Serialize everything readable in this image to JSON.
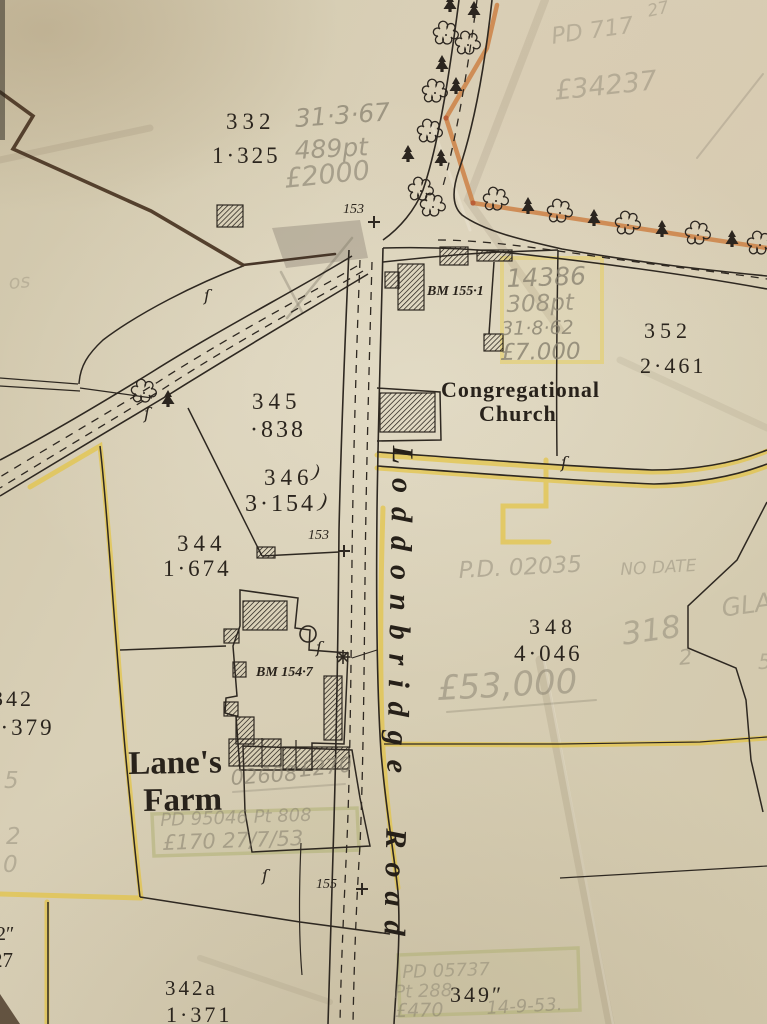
{
  "map_meta": {
    "description": "Scanned sheet of an Ordnance Survey style field parcel map with pencil valuation annotations",
    "road_name": "Loddonbridge Road"
  },
  "labels": [
    {
      "id": "parcel-332",
      "text": "332",
      "kind": "print",
      "x": 226,
      "y": 110,
      "size": 23,
      "ls": 5
    },
    {
      "id": "parcel-332-area",
      "text": "1·325",
      "kind": "print",
      "x": 212,
      "y": 144,
      "size": 23,
      "ls": 3
    },
    {
      "id": "parcel-345",
      "text": "345",
      "kind": "print",
      "x": 252,
      "y": 390,
      "size": 23,
      "ls": 5
    },
    {
      "id": "parcel-345-area",
      "text": "·838",
      "kind": "print",
      "x": 250,
      "y": 418,
      "size": 24,
      "ls": 3
    },
    {
      "id": "parcel-346",
      "text": "346",
      "kind": "print",
      "x": 264,
      "y": 466,
      "size": 23,
      "ls": 5
    },
    {
      "id": "parcel-346-area",
      "text": "3·154",
      "kind": "print",
      "x": 245,
      "y": 492,
      "size": 24,
      "ls": 3
    },
    {
      "id": "brace-1",
      "text": ")",
      "kind": "print-italic",
      "x": 315,
      "y": 462,
      "size": 19,
      "rot": 12
    },
    {
      "id": "brace-2",
      "text": ")",
      "kind": "print-italic",
      "x": 322,
      "y": 490,
      "size": 21,
      "rot": 12
    },
    {
      "id": "parcel-344",
      "text": "344",
      "kind": "print",
      "x": 177,
      "y": 532,
      "size": 23,
      "ls": 5
    },
    {
      "id": "parcel-344-area",
      "text": "1·674",
      "kind": "print",
      "x": 163,
      "y": 557,
      "size": 23,
      "ls": 3
    },
    {
      "id": "parcel-348",
      "text": "348",
      "kind": "print",
      "x": 529,
      "y": 616,
      "size": 22,
      "ls": 5
    },
    {
      "id": "parcel-348-area",
      "text": "4·046",
      "kind": "print",
      "x": 514,
      "y": 642,
      "size": 23,
      "ls": 3
    },
    {
      "id": "parcel-352",
      "text": "352",
      "kind": "print",
      "x": 644,
      "y": 320,
      "size": 22,
      "ls": 5
    },
    {
      "id": "parcel-352-area",
      "text": "2·461",
      "kind": "print",
      "x": 640,
      "y": 355,
      "size": 22,
      "ls": 3
    },
    {
      "id": "parcel-342",
      "text": "342",
      "kind": "print",
      "x": -8,
      "y": 688,
      "size": 22,
      "ls": 3
    },
    {
      "id": "parcel-342-area",
      "text": "3·379",
      "kind": "print",
      "x": -14,
      "y": 716,
      "size": 23,
      "ls": 3
    },
    {
      "id": "parcel-342a",
      "text": "342a",
      "kind": "print",
      "x": 165,
      "y": 978,
      "size": 21,
      "ls": 3
    },
    {
      "id": "parcel-342a-area",
      "text": "1·371",
      "kind": "print",
      "x": 166,
      "y": 1004,
      "size": 22,
      "ls": 3
    },
    {
      "id": "parcel-349",
      "text": "349″",
      "kind": "print",
      "x": 450,
      "y": 984,
      "size": 22,
      "ls": 3
    },
    {
      "id": "edge-2in",
      "text": "2″",
      "kind": "print",
      "x": -4,
      "y": 924,
      "size": 20
    },
    {
      "id": "edge-27",
      "text": "27",
      "kind": "print",
      "x": -8,
      "y": 950,
      "size": 21
    },
    {
      "id": "road-number-153-top",
      "text": "153",
      "kind": "print-italic",
      "x": 343,
      "y": 203,
      "size": 14
    },
    {
      "id": "road-number-153-mid",
      "text": "153",
      "kind": "print-italic",
      "x": 308,
      "y": 529,
      "size": 14
    },
    {
      "id": "road-number-155",
      "text": "155",
      "kind": "print-italic",
      "x": 316,
      "y": 878,
      "size": 14
    },
    {
      "id": "benchmark-155-1",
      "text": "BM 155·1",
      "kind": "bench",
      "x": 427,
      "y": 285,
      "size": 14
    },
    {
      "id": "benchmark-154-7",
      "text": "BM 154·7",
      "kind": "bench",
      "x": 256,
      "y": 666,
      "size": 14
    },
    {
      "id": "church-name-line1",
      "text": "Congregational",
      "kind": "print-bold",
      "x": 441,
      "y": 379,
      "size": 22,
      "ls": 1
    },
    {
      "id": "church-name-line2",
      "text": "Church",
      "kind": "print-bold",
      "x": 479,
      "y": 403,
      "size": 22,
      "ls": 1
    },
    {
      "id": "farm-name-line1",
      "text": "Lane's",
      "kind": "print-bold",
      "x": 128,
      "y": 748,
      "size": 33,
      "rot": -1
    },
    {
      "id": "farm-name-line2",
      "text": "Farm",
      "kind": "print-bold",
      "x": 143,
      "y": 785,
      "size": 33,
      "rot": -1
    },
    {
      "id": "road-name",
      "text": "Loddonbridge Road",
      "kind": "roadname",
      "x": 417,
      "y": 446,
      "size": 30,
      "rot": 91,
      "ls": 14,
      "ws": 20
    },
    {
      "id": "section-mark-1",
      "text": "ſ",
      "kind": "section",
      "x": 204,
      "y": 288,
      "size": 16
    },
    {
      "id": "section-mark-2",
      "text": "ſ",
      "kind": "section",
      "x": 144,
      "y": 406,
      "size": 16
    },
    {
      "id": "section-mark-3",
      "text": "ſ",
      "kind": "section",
      "x": 561,
      "y": 455,
      "size": 16
    },
    {
      "id": "section-mark-4",
      "text": "ſ",
      "kind": "section",
      "x": 316,
      "y": 640,
      "size": 16
    },
    {
      "id": "section-mark-5",
      "text": "ſ",
      "kind": "section",
      "x": 262,
      "y": 868,
      "size": 16
    },
    {
      "id": "pencil-date-3167",
      "text": "31·3·67",
      "kind": "pencil",
      "x": 294,
      "y": 106,
      "size": 25,
      "rot": -4,
      "op": 0.7
    },
    {
      "id": "pencil-489pt",
      "text": "489pt",
      "kind": "pencil",
      "x": 294,
      "y": 138,
      "size": 25,
      "rot": -3,
      "op": 0.65
    },
    {
      "id": "pencil-2000",
      "text": "£2000",
      "kind": "pencil",
      "x": 283,
      "y": 166,
      "size": 27,
      "rot": -6,
      "op": 0.6
    },
    {
      "id": "pencil-pd717",
      "text": "PD 717",
      "kind": "pencil",
      "x": 550,
      "y": 26,
      "size": 23,
      "rot": -8,
      "op": 0.38
    },
    {
      "id": "pencil-34237",
      "text": "£34237",
      "kind": "pencil",
      "x": 553,
      "y": 78,
      "size": 27,
      "rot": -6,
      "op": 0.42
    },
    {
      "id": "pencil-corner-27",
      "text": "27",
      "kind": "pencil",
      "x": 646,
      "y": 4,
      "size": 17,
      "rot": -12,
      "op": 0.38
    },
    {
      "id": "pencil-14386",
      "text": "14386",
      "kind": "pencil",
      "x": 506,
      "y": 266,
      "size": 25,
      "rot": -2,
      "op": 0.75
    },
    {
      "id": "pencil-308pt",
      "text": "308pt",
      "kind": "pencil",
      "x": 506,
      "y": 294,
      "size": 23,
      "rot": -2,
      "op": 0.7
    },
    {
      "id": "pencil-date-31862",
      "text": "31·8·62",
      "kind": "pencil",
      "x": 501,
      "y": 320,
      "size": 19,
      "rot": -1,
      "op": 0.78
    },
    {
      "id": "pencil-7000",
      "text": "£7.000",
      "kind": "pencil",
      "x": 500,
      "y": 342,
      "size": 23,
      "rot": -1,
      "op": 0.78
    },
    {
      "id": "pencil-pd02035",
      "text": "P.D. 02035",
      "kind": "pencil",
      "x": 458,
      "y": 560,
      "size": 23,
      "rot": -3,
      "op": 0.45
    },
    {
      "id": "pencil-no-date",
      "text": "NO DATE",
      "kind": "pencil",
      "x": 620,
      "y": 562,
      "size": 17,
      "rot": -3,
      "op": 0.42
    },
    {
      "id": "pencil-318",
      "text": "318",
      "kind": "pencil",
      "x": 620,
      "y": 620,
      "size": 31,
      "rot": -8,
      "op": 0.45
    },
    {
      "id": "pencil-318-sub",
      "text": "2",
      "kind": "pencil",
      "x": 678,
      "y": 648,
      "size": 21,
      "rot": -5,
      "op": 0.45
    },
    {
      "id": "pencil-53000",
      "text": "£53,000",
      "kind": "pencil",
      "x": 436,
      "y": 672,
      "size": 34,
      "rot": -3,
      "op": 0.5
    },
    {
      "id": "pencil-gla",
      "text": "GLA",
      "kind": "pencil",
      "x": 720,
      "y": 596,
      "size": 25,
      "rot": -8,
      "op": 0.42
    },
    {
      "id": "pencil-5-right",
      "text": "5",
      "kind": "pencil",
      "x": 758,
      "y": 652,
      "size": 21,
      "op": 0.38
    },
    {
      "id": "pencil-02608",
      "text": "02608",
      "kind": "pencil",
      "x": 230,
      "y": 768,
      "size": 21,
      "rot": -4,
      "op": 0.65
    },
    {
      "id": "pencil-270",
      "text": "£270",
      "kind": "pencil",
      "x": 298,
      "y": 760,
      "size": 21,
      "rot": -6,
      "op": 0.65
    },
    {
      "id": "pencil-pd95046",
      "text": "PD 95046  Pt 808",
      "kind": "pencil",
      "x": 160,
      "y": 812,
      "size": 18,
      "rot": -2,
      "op": 0.5
    },
    {
      "id": "pencil-170",
      "text": "£170  27/7/53",
      "kind": "pencil",
      "x": 162,
      "y": 833,
      "size": 21,
      "rot": -2,
      "op": 0.55
    },
    {
      "id": "pencil-pd05737",
      "text": "PD 05737",
      "kind": "pencil",
      "x": 402,
      "y": 964,
      "size": 18,
      "rot": -2,
      "op": 0.45
    },
    {
      "id": "pencil-pt288",
      "text": "Pt 288",
      "kind": "pencil",
      "x": 394,
      "y": 984,
      "size": 18,
      "rot": -2,
      "op": 0.45
    },
    {
      "id": "pencil-470",
      "text": "£470",
      "kind": "pencil",
      "x": 395,
      "y": 1002,
      "size": 19,
      "rot": -1,
      "op": 0.5
    },
    {
      "id": "pencil-14953",
      "text": "14-9-53.",
      "kind": "pencil",
      "x": 486,
      "y": 1000,
      "size": 18,
      "rot": -3,
      "op": 0.5
    },
    {
      "id": "pencil-5-left",
      "text": "5",
      "kind": "pencil",
      "x": 4,
      "y": 770,
      "size": 23,
      "op": 0.42
    },
    {
      "id": "pencil-2-left",
      "text": "2",
      "kind": "pencil",
      "x": 6,
      "y": 826,
      "size": 23,
      "op": 0.42
    },
    {
      "id": "pencil-0-left",
      "text": "0",
      "kind": "pencil",
      "x": 3,
      "y": 854,
      "size": 23,
      "op": 0.42
    },
    {
      "id": "pencil-scribble",
      "text": "os",
      "kind": "pencil",
      "x": 8,
      "y": 274,
      "size": 19,
      "rot": -5,
      "op": 0.32
    }
  ],
  "features": {
    "trees": [
      {
        "type": "conifer",
        "x": 450,
        "y": 4
      },
      {
        "type": "deciduous",
        "x": 446,
        "y": 34
      },
      {
        "type": "conifer",
        "x": 442,
        "y": 64
      },
      {
        "type": "deciduous",
        "x": 435,
        "y": 92
      },
      {
        "type": "deciduous",
        "x": 430,
        "y": 132
      },
      {
        "type": "conifer",
        "x": 408,
        "y": 154
      },
      {
        "type": "conifer",
        "x": 441,
        "y": 158
      },
      {
        "type": "deciduous",
        "x": 421,
        "y": 190
      },
      {
        "type": "deciduous",
        "x": 433,
        "y": 206
      },
      {
        "type": "conifer",
        "x": 474,
        "y": 10
      },
      {
        "type": "deciduous",
        "x": 468,
        "y": 44
      },
      {
        "type": "conifer",
        "x": 456,
        "y": 86
      },
      {
        "type": "deciduous",
        "x": 496,
        "y": 200
      },
      {
        "type": "conifer",
        "x": 528,
        "y": 206
      },
      {
        "type": "deciduous",
        "x": 560,
        "y": 212
      },
      {
        "type": "conifer",
        "x": 594,
        "y": 218
      },
      {
        "type": "deciduous",
        "x": 628,
        "y": 224
      },
      {
        "type": "conifer",
        "x": 662,
        "y": 229
      },
      {
        "type": "deciduous",
        "x": 698,
        "y": 234
      },
      {
        "type": "conifer",
        "x": 732,
        "y": 239
      },
      {
        "type": "deciduous",
        "x": 760,
        "y": 244
      },
      {
        "type": "deciduous",
        "x": 144,
        "y": 392
      },
      {
        "type": "conifer",
        "x": 168,
        "y": 399
      }
    ],
    "buildings": [
      {
        "x": 217,
        "y": 205,
        "w": 26,
        "h": 22
      },
      {
        "x": 398,
        "y": 264,
        "w": 26,
        "h": 46
      },
      {
        "x": 385,
        "y": 272,
        "w": 14,
        "h": 16
      },
      {
        "x": 440,
        "y": 247,
        "w": 28,
        "h": 18
      },
      {
        "x": 477,
        "y": 250,
        "w": 35,
        "h": 11
      },
      {
        "x": 484,
        "y": 334,
        "w": 19,
        "h": 17
      },
      {
        "x": 380,
        "y": 393,
        "w": 55,
        "h": 39
      },
      {
        "x": 243,
        "y": 601,
        "w": 44,
        "h": 29
      },
      {
        "x": 224,
        "y": 629,
        "w": 15,
        "h": 14
      },
      {
        "x": 233,
        "y": 662,
        "w": 13,
        "h": 15
      },
      {
        "x": 224,
        "y": 702,
        "w": 14,
        "h": 14
      },
      {
        "x": 236,
        "y": 717,
        "w": 18,
        "h": 27
      },
      {
        "x": 324,
        "y": 676,
        "w": 18,
        "h": 64
      },
      {
        "x": 229,
        "y": 739,
        "w": 52,
        "h": 27
      },
      {
        "x": 283,
        "y": 747,
        "w": 66,
        "h": 22
      },
      {
        "x": 257,
        "y": 547,
        "w": 18,
        "h": 11
      }
    ],
    "benchmark_crosses": [
      {
        "x": 374,
        "y": 222
      },
      {
        "x": 344,
        "y": 551
      },
      {
        "x": 362,
        "y": 889
      }
    ],
    "pond": {
      "cx": 308,
      "cy": 634,
      "r": 8
    },
    "star": {
      "cx": 343,
      "cy": 657
    }
  },
  "colors": {
    "paper": "#d6cdb3",
    "ink": "#2e2821",
    "pencil": "#857e6d",
    "road_yellow": "#e5c43e",
    "boundary_orange": "#cd8145",
    "boundary_brown": "#54402d",
    "green_tint": "#b3b378"
  }
}
